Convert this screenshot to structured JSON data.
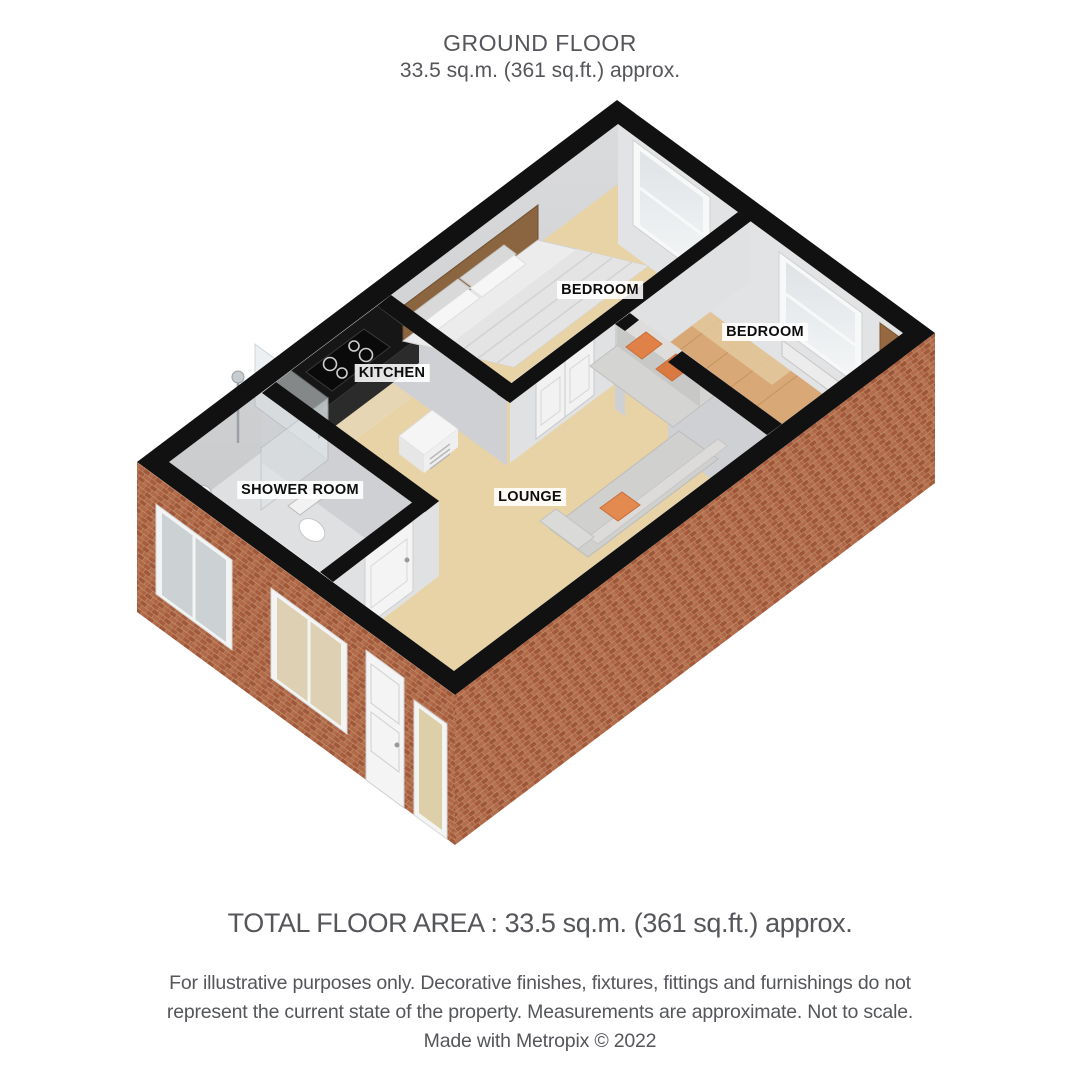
{
  "header": {
    "title": "GROUND FLOOR",
    "subtitle": "33.5 sq.m. (361 sq.ft.) approx."
  },
  "rooms": {
    "bedroom_top": {
      "label": "BEDROOM"
    },
    "bedroom_right": {
      "label": "BEDROOM"
    },
    "kitchen": {
      "label": "KITCHEN"
    },
    "shower_room": {
      "label": "SHOWER ROOM"
    },
    "lounge": {
      "label": "LOUNGE"
    }
  },
  "footer": {
    "total_area": "TOTAL FLOOR AREA : 33.5 sq.m. (361 sq.ft.) approx.",
    "disclaimer_lines": [
      "For illustrative purposes only. Decorative finishes, fixtures, fittings and furnishings do not",
      "represent the current state of the property. Measurements are approximate. Not to scale.",
      "Made with Metropix © 2022"
    ]
  },
  "colors": {
    "wall_outline": "#111111",
    "brick": "#a8613f",
    "floor_beige": "#e8d3a7",
    "floor_wood": "#d8a877",
    "cushion_orange": "#e08148",
    "text_gray": "#54565a"
  }
}
